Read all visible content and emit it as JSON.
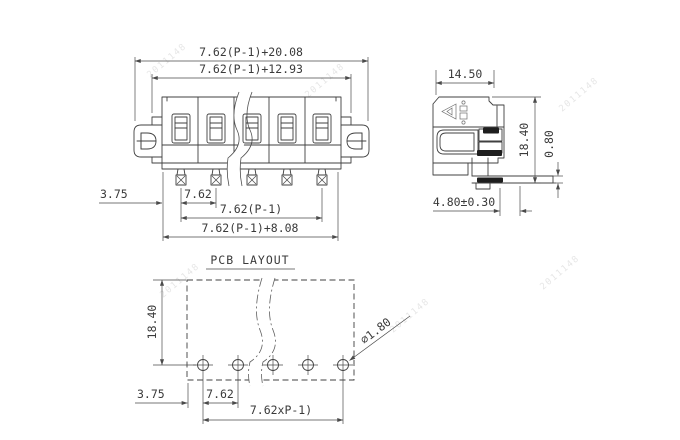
{
  "drawing": {
    "type": "terminal-block connector dimension drawing",
    "front_view": {
      "dim_total_width": "7.62(P-1)+20.08",
      "dim_flange_width": "7.62(P-1)+12.93",
      "dim_edge_to_pin": "3.75",
      "dim_pitch": "7.62",
      "dim_pin_span": "7.62(P-1)",
      "dim_body_width": "7.62(P-1)+8.08",
      "positions_shown": 5
    },
    "side_view": {
      "dim_depth": "14.50",
      "dim_height": "18.40",
      "dim_pin_thickness": "0.80",
      "dim_pin_length": "4.80±0.30"
    },
    "pcb_layout": {
      "title": "PCB LAYOUT",
      "dim_height": "18.40",
      "dim_edge_to_hole": "3.75",
      "dim_pitch": "7.62",
      "dim_hole_span": "7.62xP-1)",
      "dim_hole_diameter": "∅1.80",
      "holes_shown": 5
    },
    "watermark_text": "2011148",
    "colors": {
      "background": "#ffffff",
      "line": "#404040",
      "text": "#3a3a3a",
      "watermark": "#c8c8c8"
    }
  }
}
